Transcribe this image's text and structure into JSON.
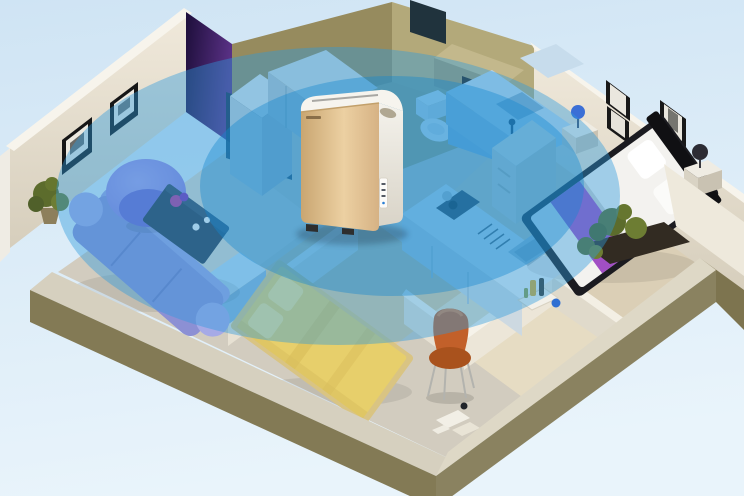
{
  "colors": {
    "background_top": "#cfe4f4",
    "background_bottom": "#e9f4fb",
    "coverage_outer": "#2e9ade",
    "coverage_inner": "#1486cf",
    "outer_wall_olive": "#837a55",
    "outer_wall_top": "#d6d0bf",
    "wall_cream": "#f0e9db",
    "wall_cream_shade": "#d6cebc",
    "wall_accent_dark": "#1d0e3a",
    "wall_accent_light": "#5a3186",
    "wall_tan_dark": "#968b5e",
    "wall_tan_light": "#b3a97a",
    "floor_base": "#d2ccbf",
    "floor_wood": "#ddc99f",
    "floor_wood_light": "#e6dcc3",
    "sofa_purple": "#8c90d4",
    "chair_purple": "#8678d8",
    "coffee_table_dark": "#2d3b4e",
    "tv_cabinet_blue": "#badaf0",
    "cabinet_blue": "#b9d4e8",
    "bed_yellow": "#e7cf6b",
    "bed_mattress_white": "#f3f2ef",
    "bed_frame_dark": "#1b1b20",
    "bed_runner_purple": "#a14fc4",
    "study_chair_orange": "#c2602a",
    "plant_green": "#5c6c2c",
    "purifier_gold_dark": "#c9a671",
    "purifier_gold_mid": "#ecd0a2",
    "purifier_gold_light": "#d6b284",
    "purifier_white": "#f4f2ec"
  }
}
